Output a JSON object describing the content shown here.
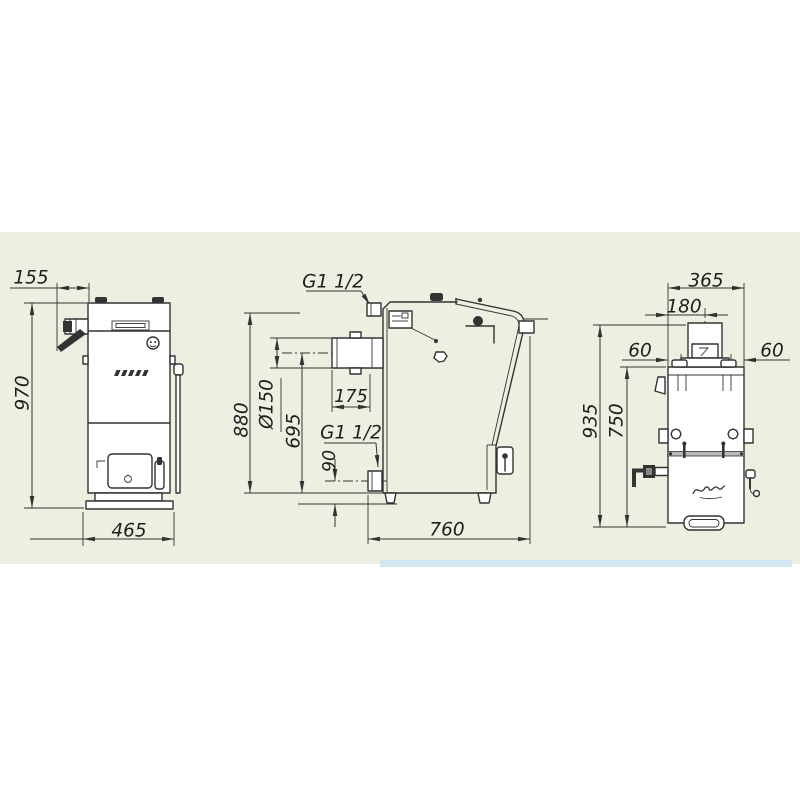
{
  "front_view": {
    "lever_offset": "155",
    "height": "970",
    "width": "465"
  },
  "side_view": {
    "supply_thread": "G1 1/2",
    "flue_diameter": "Ø150",
    "flue_length": "175",
    "body_height": "880",
    "flue_axis_height": "695",
    "return_thread": "G1 1/2",
    "return_axis_height": "90",
    "depth": "760"
  },
  "rear_view": {
    "width": "365",
    "flue_offset": "180",
    "left_stub_offset": "60",
    "right_stub_offset": "60",
    "overall_height": "935",
    "body_height": "750"
  },
  "colors": {
    "panel_background": "#edf0e1",
    "bottom_strip": "#d3e5ef",
    "drawing_line": "#333333"
  }
}
